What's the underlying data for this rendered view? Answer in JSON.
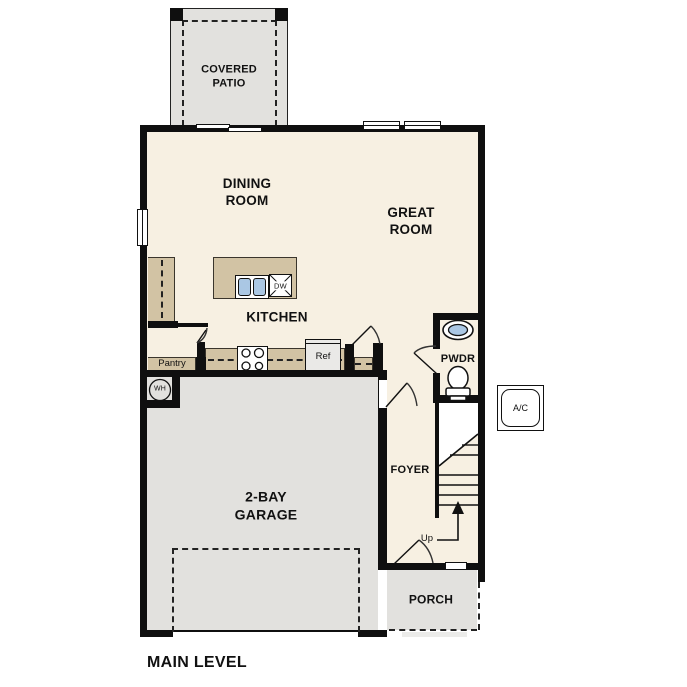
{
  "plan": {
    "title": "MAIN LEVEL",
    "rooms": {
      "covered_patio": "COVERED PATIO",
      "dining_room": "DINING ROOM",
      "great_room": "GREAT ROOM",
      "kitchen": "KITCHEN",
      "pantry": "Pantry",
      "powder_room": "PWDR",
      "foyer": "FOYER",
      "garage": "2-BAY GARAGE",
      "porch": "PORCH"
    },
    "fixtures": {
      "dishwasher": "DW",
      "refrigerator": "Ref",
      "water_heater": "WH",
      "ac_unit": "A/C",
      "stairs_direction": "Up"
    },
    "colors": {
      "floor": "#f7f0e2",
      "casework_tan": "#d2c3a4",
      "concrete_gray": "#e2e1de",
      "wall_black": "#0f0f0f",
      "sink_blue": "#aac7e4",
      "appliance_gray": "#eae9e7"
    }
  }
}
